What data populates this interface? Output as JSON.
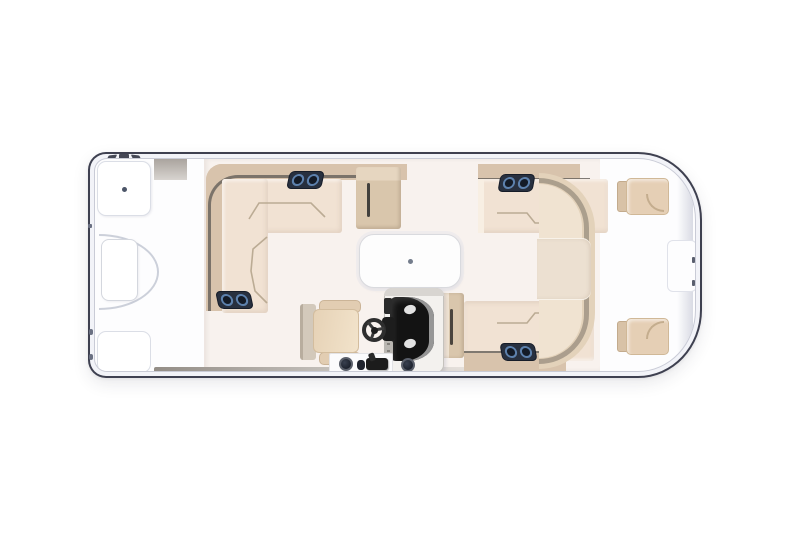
{
  "scene": {
    "type": "boat-floor-plan",
    "subject": "pontoon-boat-top-view",
    "orientation": "horizontal",
    "features": [
      "bow-platform",
      "bow-boarding-gate",
      "bow-storage-hatch-top",
      "bow-storage-hatch-bottom",
      "port-l-shaped-lounge",
      "lounge-storage-console",
      "starboard-forward-lounge",
      "starboard-aft-lounge",
      "wraparound-stern-lounge",
      "stern-walkway-pad",
      "removable-table",
      "helm-console",
      "windscreen-dash",
      "gauges",
      "captains-chair",
      "steering-wheel",
      "throttle-control",
      "cup-holders",
      "speaker-pairs",
      "stern-jump-seat-top",
      "stern-jump-seat-bottom",
      "engine-well",
      "boarding-ladder-ticks",
      "cleats",
      "deck-edge-strip"
    ],
    "counts": {
      "speaker_pairs": 4,
      "stern_jump_seats": 2,
      "tables": 1,
      "gauges": 2,
      "cup_holders": 3
    }
  },
  "colors": {
    "background": "#ffffff",
    "hull_outline": "#3e4050",
    "rim_fill": "#f2f3f8",
    "rim_inner_line": "#c9cbd6",
    "bow_deck": "#fdfdfe",
    "main_deck": "#f8f2ee",
    "seat": "#f1e2d3",
    "seat_highlight": "#f8efe3",
    "backrest": "#d8c3ac",
    "cabinet": "#d9c6ac",
    "seam": "#b5a58d",
    "rail": "#6b655e",
    "edge_strip": "#938d86",
    "speaker_box": "#28303f",
    "speaker_ring": "#5d81ad",
    "speaker_center": "#141b27",
    "table": "#fdfdfd",
    "table_line": "#d9dade",
    "console_body": "#f3f1ee",
    "console_dark": "#131313",
    "console_reflection": "#969696",
    "chair_seat": "#ecd9bf",
    "chair_arm": "#e2cdb2",
    "chair_back": "#d3c9bb",
    "wheel": "#2e2e2e",
    "stern_seat": "#e5cfb5",
    "stern_band": "#ece0d1",
    "stadium": "#e3d2ba",
    "metal_dot": "#7f889c"
  }
}
